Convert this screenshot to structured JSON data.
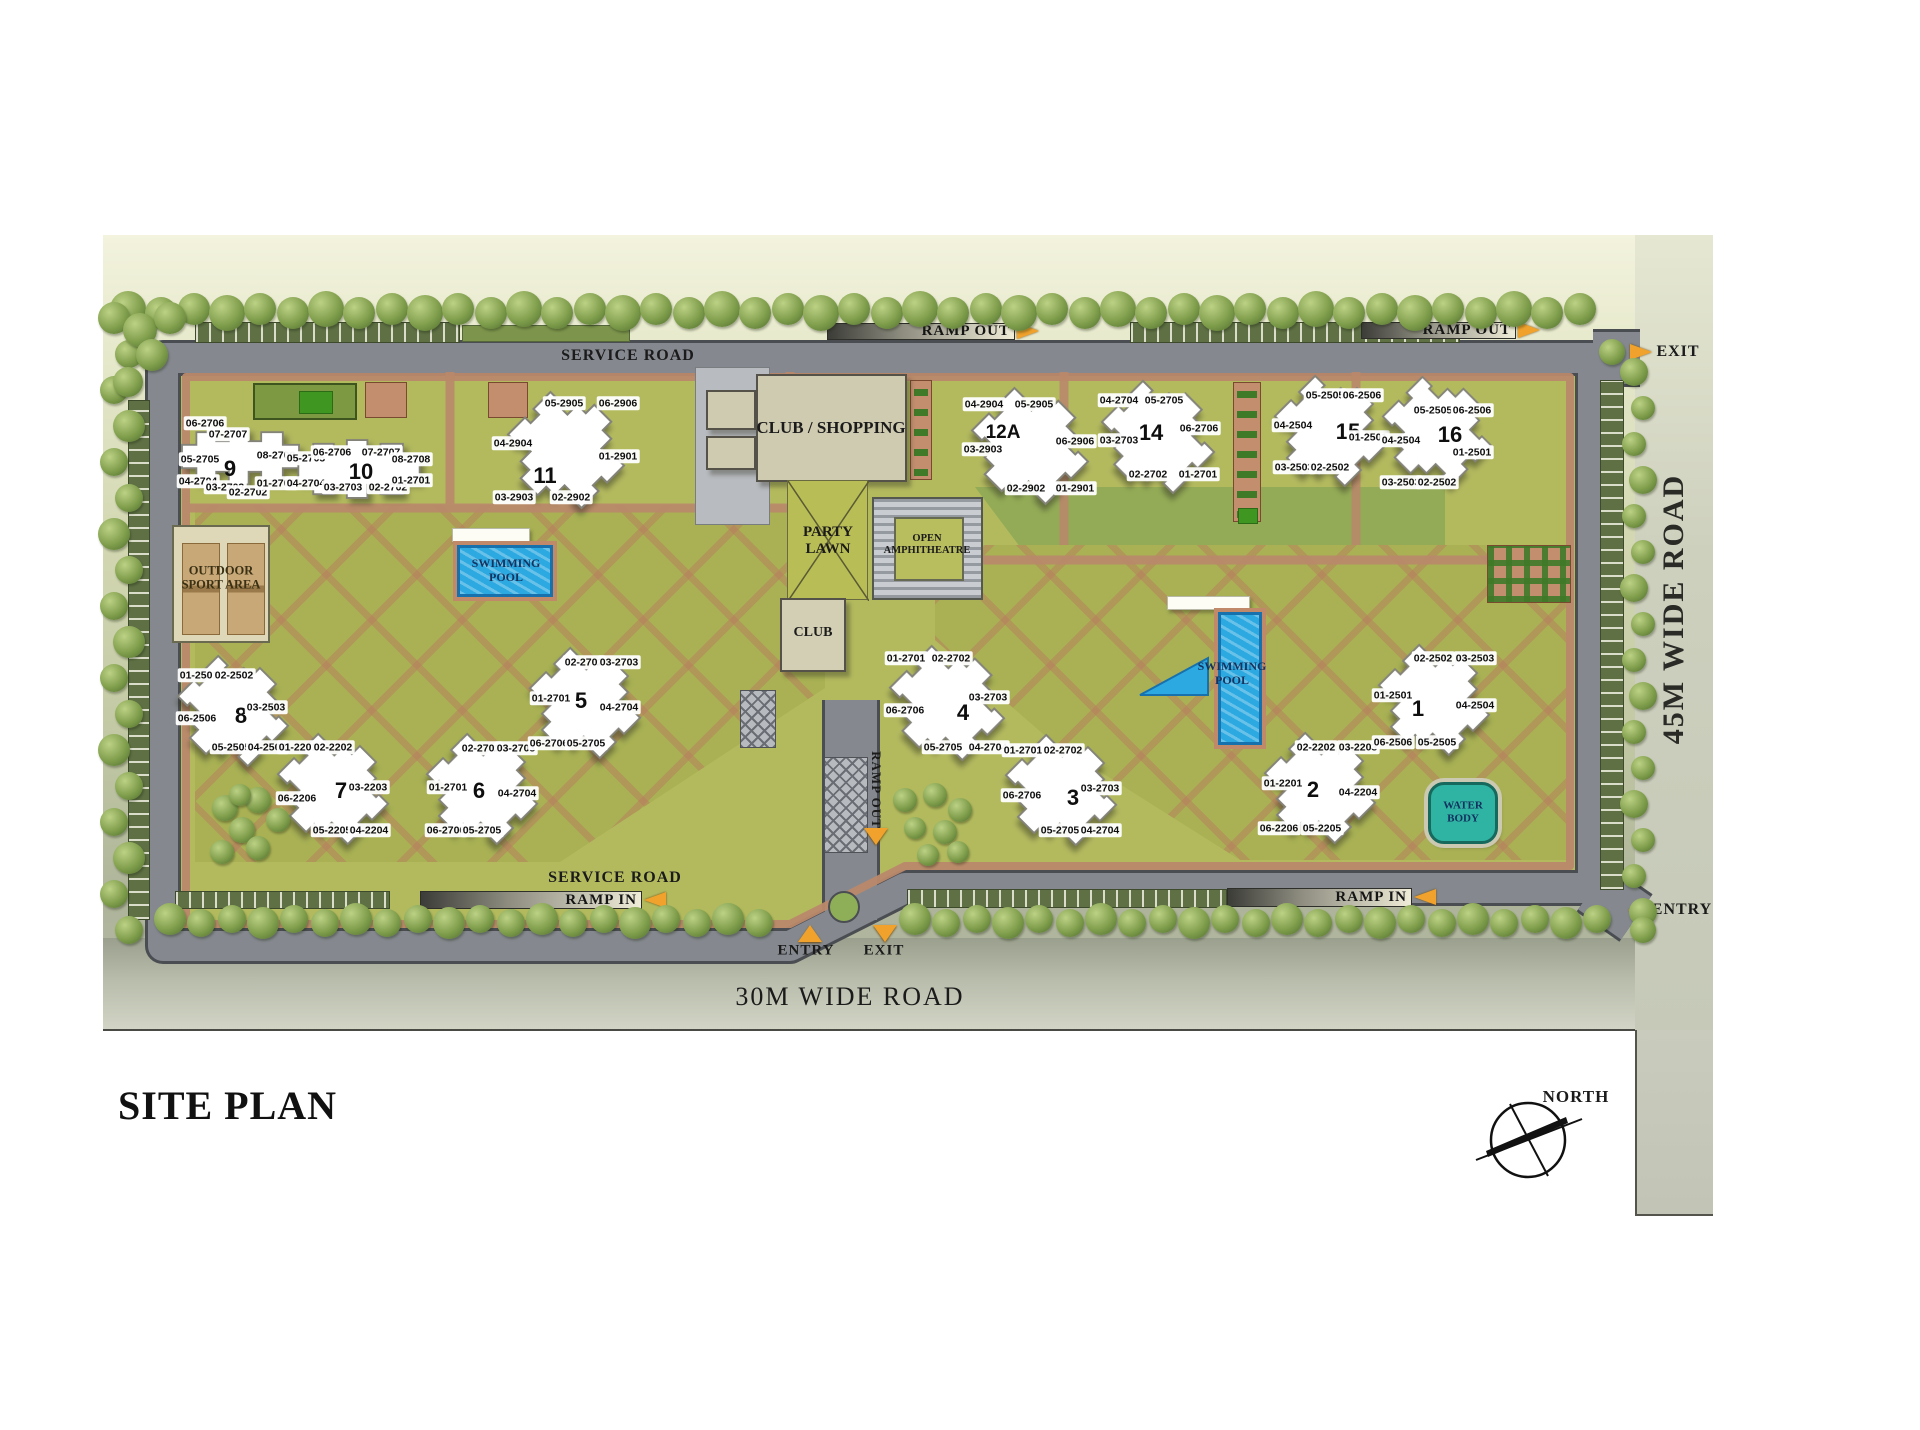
{
  "title": "SITE PLAN",
  "compass": {
    "label": "NORTH"
  },
  "roads": {
    "right_vertical": "45M WIDE ROAD",
    "bottom": "30M WIDE ROAD",
    "service_top": "SERVICE ROAD",
    "service_bottom": "SERVICE ROAD"
  },
  "ramps": {
    "out_top_left": "RAMP OUT",
    "out_top_right": "RAMP OUT",
    "out_center_vertical": "RAMP OUT",
    "in_bottom_left": "RAMP IN",
    "in_bottom_right": "RAMP IN"
  },
  "gates": {
    "exit_top_right": "EXIT",
    "entry_bottom_right": "ENTRY",
    "entry_bottom_center": "ENTRY",
    "exit_bottom_center": "EXIT"
  },
  "amenities": {
    "club_shopping": "CLUB / SHOPPING",
    "party_lawn": "PARTY\nLAWN",
    "amphitheatre": "OPEN\nAMPHITHEATRE",
    "club": "CLUB",
    "swimming_pool_left": "SWIMMING\nPOOL",
    "swimming_pool_right": "SWIMMING\nPOOL",
    "water_body": "WATER\nBODY",
    "outdoor_sport": "OUTDOOR\nSPORT AREA"
  },
  "colors": {
    "lawn": "#b3ba5e",
    "park_dark_green": "#93ab56",
    "path_salmon": "#b9886a",
    "road_gray": "#85898f",
    "pool_blue": "#2da9e1",
    "water_teal": "#2fb3a3",
    "arrow_orange": "#f0a22c",
    "tree_green": "#7d9c4a"
  },
  "towers": [
    {
      "num": "9",
      "x": 230,
      "y": 469,
      "sx": 240,
      "sy": 456,
      "shape": "chain",
      "sw": 135,
      "units": [
        {
          "t": "06-2706",
          "x": 205,
          "y": 423
        },
        {
          "t": "07-2707",
          "x": 228,
          "y": 434
        },
        {
          "t": "05-2705",
          "x": 200,
          "y": 459
        },
        {
          "t": "08-2708",
          "x": 276,
          "y": 455
        },
        {
          "t": "04-2704",
          "x": 198,
          "y": 481
        },
        {
          "t": "03-2703",
          "x": 225,
          "y": 487
        },
        {
          "t": "02-2702",
          "x": 248,
          "y": 492
        },
        {
          "t": "01-2701",
          "x": 276,
          "y": 483
        }
      ]
    },
    {
      "num": "10",
      "x": 361,
      "y": 472,
      "sx": 359,
      "sy": 469,
      "shape": "chain",
      "sw": 140,
      "units": [
        {
          "t": "05-2705",
          "x": 306,
          "y": 458
        },
        {
          "t": "06-2706",
          "x": 332,
          "y": 452
        },
        {
          "t": "07-2707",
          "x": 381,
          "y": 452
        },
        {
          "t": "08-2708",
          "x": 411,
          "y": 459
        },
        {
          "t": "04-2704",
          "x": 306,
          "y": 483
        },
        {
          "t": "03-2703",
          "x": 343,
          "y": 487
        },
        {
          "t": "02-2702",
          "x": 388,
          "y": 487
        },
        {
          "t": "01-2701",
          "x": 411,
          "y": 480
        }
      ]
    },
    {
      "num": "11",
      "x": 545,
      "y": 476,
      "sx": 566,
      "sy": 450,
      "shape": "cross",
      "sw": 120,
      "units": [
        {
          "t": "05-2905",
          "x": 564,
          "y": 403
        },
        {
          "t": "06-2906",
          "x": 618,
          "y": 403
        },
        {
          "t": "04-2904",
          "x": 513,
          "y": 443
        },
        {
          "t": "01-2901",
          "x": 618,
          "y": 456
        },
        {
          "t": "03-2903",
          "x": 514,
          "y": 497
        },
        {
          "t": "02-2902",
          "x": 571,
          "y": 497
        }
      ]
    },
    {
      "num": "12A",
      "x": 1003,
      "y": 433,
      "sx": 1030,
      "sy": 446,
      "shape": "cross",
      "sw": 120,
      "units": [
        {
          "t": "04-2904",
          "x": 984,
          "y": 404
        },
        {
          "t": "05-2905",
          "x": 1034,
          "y": 404
        },
        {
          "t": "03-2903",
          "x": 983,
          "y": 449
        },
        {
          "t": "06-2906",
          "x": 1075,
          "y": 441
        },
        {
          "t": "02-2902",
          "x": 1026,
          "y": 488
        },
        {
          "t": "01-2901",
          "x": 1075,
          "y": 488
        }
      ]
    },
    {
      "num": "14",
      "x": 1151,
      "y": 433,
      "sx": 1158,
      "sy": 437,
      "shape": "cross",
      "sw": 116,
      "units": [
        {
          "t": "04-2704",
          "x": 1119,
          "y": 400
        },
        {
          "t": "05-2705",
          "x": 1164,
          "y": 400
        },
        {
          "t": "03-2703",
          "x": 1119,
          "y": 440
        },
        {
          "t": "06-2706",
          "x": 1199,
          "y": 428
        },
        {
          "t": "02-2702",
          "x": 1148,
          "y": 474
        },
        {
          "t": "01-2701",
          "x": 1198,
          "y": 474
        }
      ]
    },
    {
      "num": "15",
      "x": 1348,
      "y": 432,
      "sx": 1330,
      "sy": 431,
      "shape": "cross",
      "sw": 114,
      "units": [
        {
          "t": "05-2505",
          "x": 1325,
          "y": 395
        },
        {
          "t": "06-2506",
          "x": 1362,
          "y": 395
        },
        {
          "t": "04-2504",
          "x": 1293,
          "y": 425
        },
        {
          "t": "01-2501",
          "x": 1368,
          "y": 437
        },
        {
          "t": "03-2503",
          "x": 1294,
          "y": 467
        },
        {
          "t": "02-2502",
          "x": 1330,
          "y": 467
        }
      ]
    },
    {
      "num": "16",
      "x": 1450,
      "y": 435,
      "sx": 1437,
      "sy": 431,
      "shape": "cross",
      "sw": 112,
      "units": [
        {
          "t": "05-2505",
          "x": 1433,
          "y": 410
        },
        {
          "t": "06-2506",
          "x": 1472,
          "y": 410
        },
        {
          "t": "04-2504",
          "x": 1401,
          "y": 440
        },
        {
          "t": "01-2501",
          "x": 1472,
          "y": 452
        },
        {
          "t": "03-2503",
          "x": 1401,
          "y": 482
        },
        {
          "t": "02-2502",
          "x": 1437,
          "y": 482
        }
      ]
    },
    {
      "num": "8",
      "x": 241,
      "y": 716,
      "sx": 233,
      "sy": 711,
      "shape": "cross",
      "sw": 114,
      "units": [
        {
          "t": "01-2501",
          "x": 199,
          "y": 675
        },
        {
          "t": "02-2502",
          "x": 234,
          "y": 675
        },
        {
          "t": "03-2503",
          "x": 266,
          "y": 707
        },
        {
          "t": "06-2506",
          "x": 197,
          "y": 718
        },
        {
          "t": "05-2505",
          "x": 231,
          "y": 747
        },
        {
          "t": "04-2504",
          "x": 267,
          "y": 747
        }
      ]
    },
    {
      "num": "7",
      "x": 341,
      "y": 791,
      "sx": 333,
      "sy": 789,
      "shape": "cross",
      "sw": 114,
      "units": [
        {
          "t": "01-2201",
          "x": 298,
          "y": 747
        },
        {
          "t": "02-2202",
          "x": 333,
          "y": 747
        },
        {
          "t": "03-2203",
          "x": 368,
          "y": 787
        },
        {
          "t": "06-2206",
          "x": 297,
          "y": 798
        },
        {
          "t": "05-2205",
          "x": 332,
          "y": 830
        },
        {
          "t": "04-2204",
          "x": 369,
          "y": 830
        }
      ]
    },
    {
      "num": "6",
      "x": 479,
      "y": 791,
      "sx": 482,
      "sy": 789,
      "shape": "cross",
      "sw": 114,
      "units": [
        {
          "t": "02-2702",
          "x": 481,
          "y": 748
        },
        {
          "t": "03-2703",
          "x": 516,
          "y": 748
        },
        {
          "t": "01-2701",
          "x": 448,
          "y": 787
        },
        {
          "t": "04-2704",
          "x": 517,
          "y": 793
        },
        {
          "t": "06-2706",
          "x": 446,
          "y": 830
        },
        {
          "t": "05-2705",
          "x": 482,
          "y": 830
        }
      ]
    },
    {
      "num": "5",
      "x": 581,
      "y": 701,
      "sx": 585,
      "sy": 703,
      "shape": "cross",
      "sw": 114,
      "units": [
        {
          "t": "02-2702",
          "x": 584,
          "y": 662
        },
        {
          "t": "03-2703",
          "x": 619,
          "y": 662
        },
        {
          "t": "01-2701",
          "x": 551,
          "y": 698
        },
        {
          "t": "04-2704",
          "x": 619,
          "y": 707
        },
        {
          "t": "06-2706",
          "x": 549,
          "y": 743
        },
        {
          "t": "05-2705",
          "x": 586,
          "y": 743
        }
      ]
    },
    {
      "num": "4",
      "x": 963,
      "y": 713,
      "sx": 947,
      "sy": 703,
      "shape": "cross",
      "sw": 118,
      "units": [
        {
          "t": "01-2701",
          "x": 906,
          "y": 658
        },
        {
          "t": "02-2702",
          "x": 951,
          "y": 658
        },
        {
          "t": "03-2703",
          "x": 988,
          "y": 697
        },
        {
          "t": "06-2706",
          "x": 905,
          "y": 710
        },
        {
          "t": "05-2705",
          "x": 943,
          "y": 747
        },
        {
          "t": "04-2704",
          "x": 988,
          "y": 747
        }
      ]
    },
    {
      "num": "3",
      "x": 1073,
      "y": 798,
      "sx": 1061,
      "sy": 790,
      "shape": "cross",
      "sw": 114,
      "units": [
        {
          "t": "01-2701",
          "x": 1023,
          "y": 750
        },
        {
          "t": "02-2702",
          "x": 1063,
          "y": 750
        },
        {
          "t": "03-2703",
          "x": 1100,
          "y": 788
        },
        {
          "t": "06-2706",
          "x": 1022,
          "y": 795
        },
        {
          "t": "05-2705",
          "x": 1060,
          "y": 830
        },
        {
          "t": "04-2704",
          "x": 1100,
          "y": 830
        }
      ]
    },
    {
      "num": "2",
      "x": 1313,
      "y": 790,
      "sx": 1320,
      "sy": 788,
      "shape": "cross",
      "sw": 114,
      "units": [
        {
          "t": "01-2201",
          "x": 1283,
          "y": 783
        },
        {
          "t": "02-2202",
          "x": 1316,
          "y": 747
        },
        {
          "t": "03-2203",
          "x": 1358,
          "y": 747
        },
        {
          "t": "04-2204",
          "x": 1358,
          "y": 792
        },
        {
          "t": "06-2206",
          "x": 1279,
          "y": 828
        },
        {
          "t": "05-2205",
          "x": 1322,
          "y": 828
        }
      ]
    },
    {
      "num": "1",
      "x": 1418,
      "y": 709,
      "sx": 1434,
      "sy": 700,
      "shape": "cross",
      "sw": 114,
      "units": [
        {
          "t": "02-2502",
          "x": 1433,
          "y": 658
        },
        {
          "t": "03-2503",
          "x": 1475,
          "y": 658
        },
        {
          "t": "01-2501",
          "x": 1393,
          "y": 695
        },
        {
          "t": "04-2504",
          "x": 1475,
          "y": 705
        },
        {
          "t": "06-2506",
          "x": 1393,
          "y": 742
        },
        {
          "t": "05-2505",
          "x": 1437,
          "y": 742
        }
      ]
    }
  ],
  "trees": {
    "rows": [
      {
        "axis": "h",
        "x0": 128,
        "y": 311,
        "n": 45,
        "step": 33,
        "r": 16
      },
      {
        "axis": "h",
        "x0": 170,
        "y": 921,
        "n": 20,
        "step": 31,
        "r": 14
      },
      {
        "axis": "h",
        "x0": 915,
        "y": 921,
        "n": 23,
        "step": 31,
        "r": 14
      },
      {
        "axis": "v",
        "x": 119,
        "y0": 318,
        "n": 18,
        "step": 36,
        "r": 14,
        "jitter": 10
      },
      {
        "axis": "v",
        "x": 1637,
        "y0": 372,
        "n": 16,
        "step": 36,
        "r": 12
      }
    ],
    "extra": [
      [
        140,
        330,
        17
      ],
      [
        170,
        318,
        16
      ],
      [
        152,
        355,
        16
      ],
      [
        128,
        382,
        15
      ],
      [
        225,
        808,
        13
      ],
      [
        258,
        800,
        13
      ],
      [
        242,
        830,
        13
      ],
      [
        222,
        852,
        12
      ],
      [
        258,
        848,
        12
      ],
      [
        278,
        820,
        12
      ],
      [
        240,
        795,
        11
      ],
      [
        905,
        800,
        12
      ],
      [
        935,
        795,
        12
      ],
      [
        960,
        810,
        12
      ],
      [
        915,
        828,
        11
      ],
      [
        945,
        832,
        12
      ],
      [
        928,
        855,
        11
      ],
      [
        958,
        852,
        11
      ],
      [
        1643,
        930,
        13
      ],
      [
        1612,
        352,
        13
      ]
    ]
  }
}
